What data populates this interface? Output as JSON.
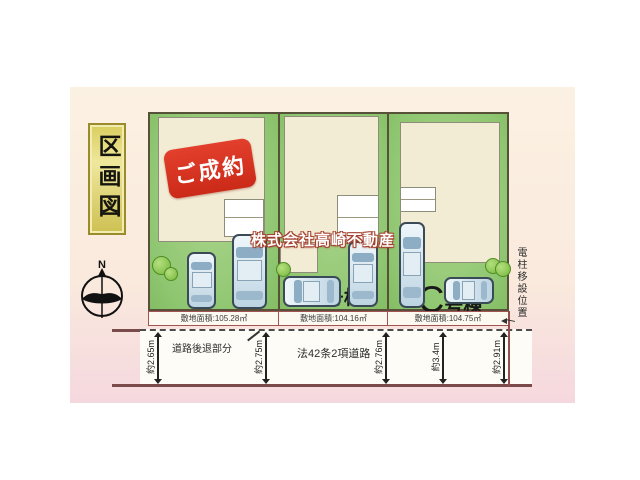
{
  "diagram": {
    "title_vertical": "区画図",
    "compass_north": "N",
    "watermark": "株式会社高崎不動産",
    "pole_note": "電柱移設位置"
  },
  "lots": [
    {
      "badge": "ご成約",
      "area": "敷地面積:105.28㎡"
    },
    {
      "name_main": "B",
      "name_suffix": "号棟",
      "area": "敷地面積:104.16㎡"
    },
    {
      "name_main": "C",
      "name_suffix": "号棟",
      "area": "敷地面積:104.75㎡"
    }
  ],
  "road": {
    "setback_label": "道路後退部分",
    "type_label": "法42条2項道路",
    "widths": [
      "約2.65m",
      "約2.75m",
      "約2.76m",
      "約3.4m",
      "約2.91m"
    ]
  },
  "colors": {
    "lot_green": "#8fc671",
    "house_cream": "#f3ecd5",
    "badge_red": "#d2311c",
    "road_line": "#7b4a4a",
    "title_gold": "#d9cd5e",
    "canvas_top": "#fbf1e2",
    "canvas_bottom": "#f5d8de"
  }
}
